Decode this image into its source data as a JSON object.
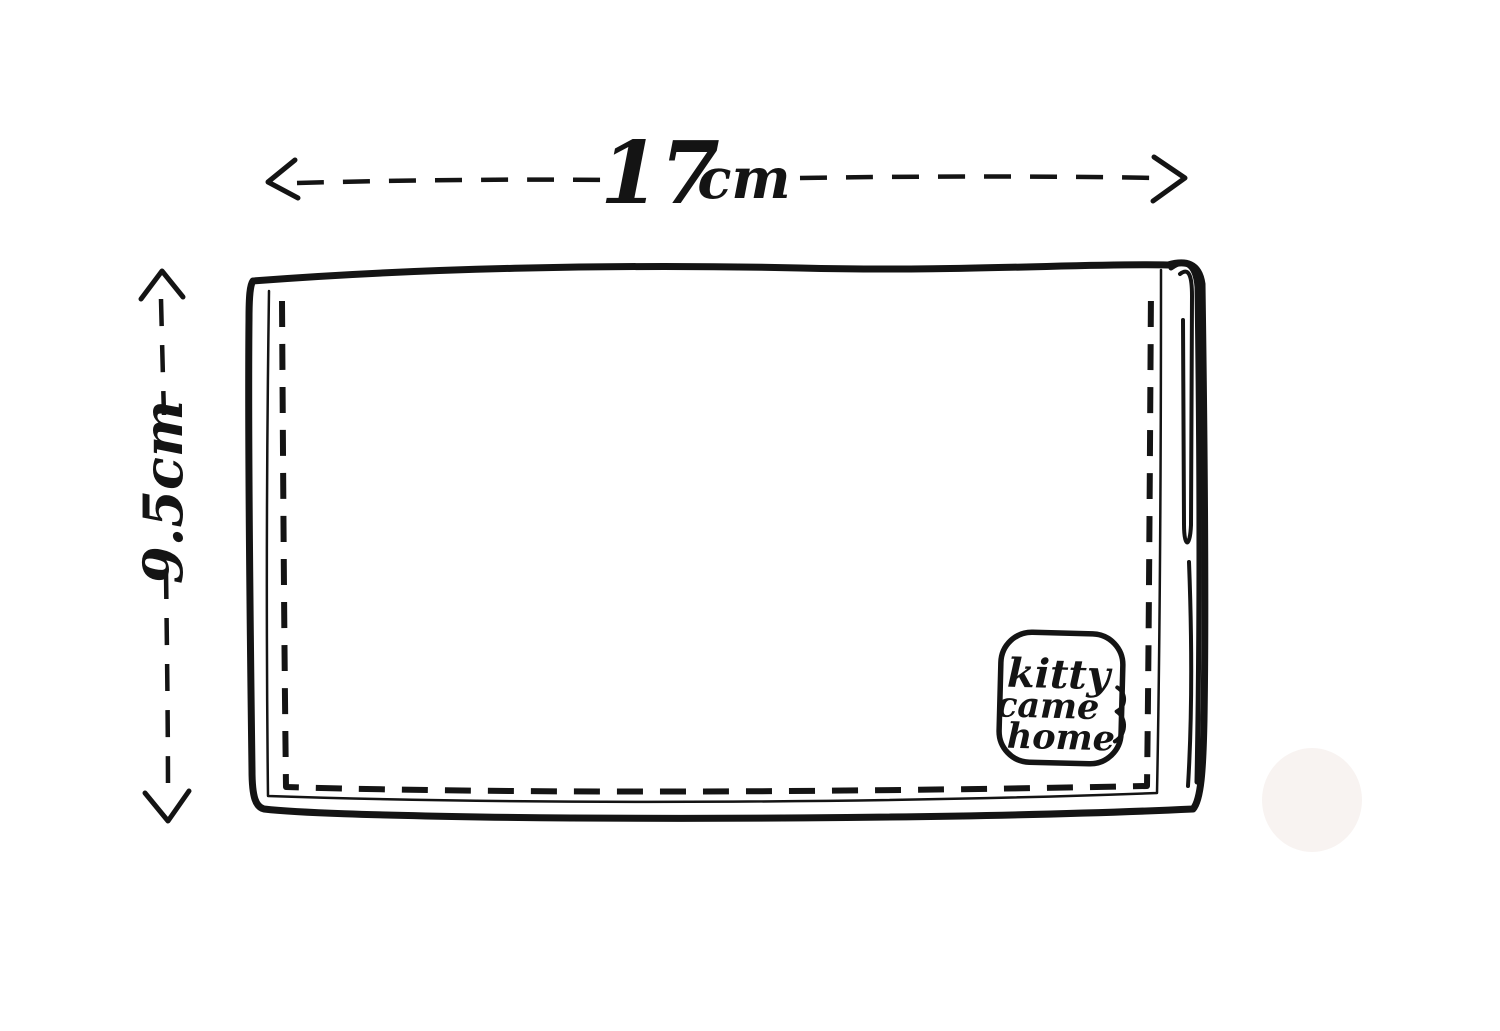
{
  "colors": {
    "ink": "#141414",
    "paper": "#ffffff",
    "smudge": "#f8f3f1"
  },
  "dimensions": {
    "width": {
      "value": "17",
      "unit": "cm"
    },
    "height": {
      "label": "9.5cm"
    }
  },
  "logo": {
    "line1": "kitty",
    "line2": "came",
    "line3": "home"
  },
  "icons": {
    "width_arrows": "left-right-dashed-arrow",
    "height_arrows": "up-down-dashed-arrow"
  }
}
